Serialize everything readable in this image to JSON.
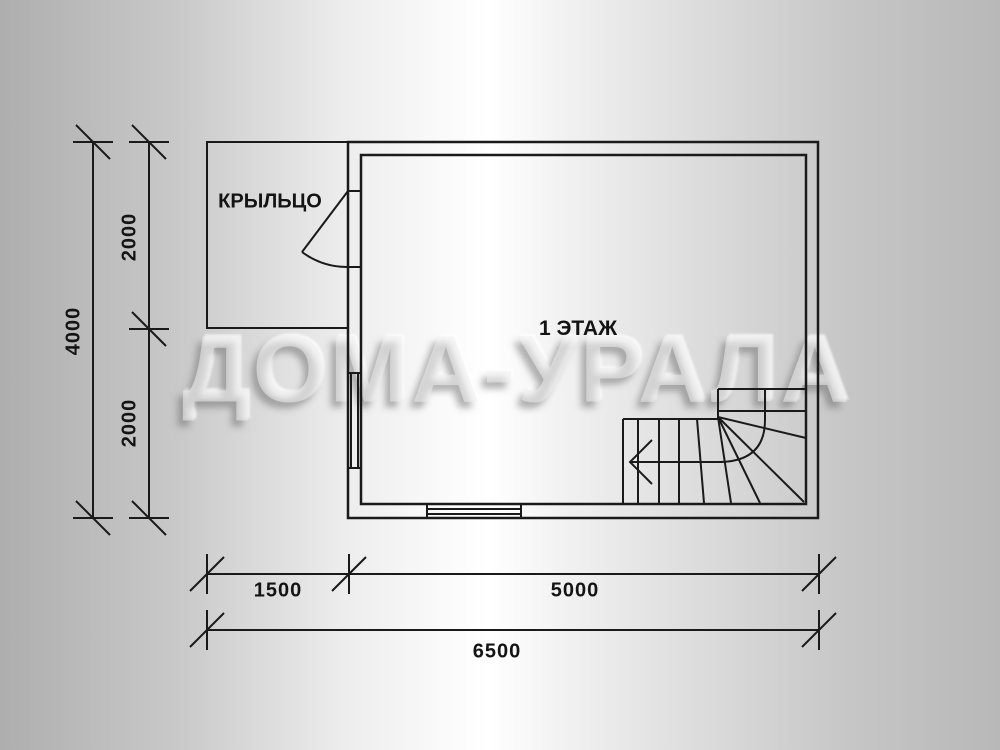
{
  "watermark": "ДОМА-УРАЛА",
  "labels": {
    "floor": "1 ЭТАЖ",
    "porch": "КРЫЛЬЦО"
  },
  "dimensions": {
    "vertical_total": "4000",
    "vertical_upper": "2000",
    "vertical_lower": "2000",
    "horizontal_porch": "1500",
    "horizontal_house": "5000",
    "horizontal_total": "6500"
  },
  "colors": {
    "line": "#1a1a1a",
    "background_edge": "#b0b0b0",
    "background_center": "#fbfbfb"
  }
}
